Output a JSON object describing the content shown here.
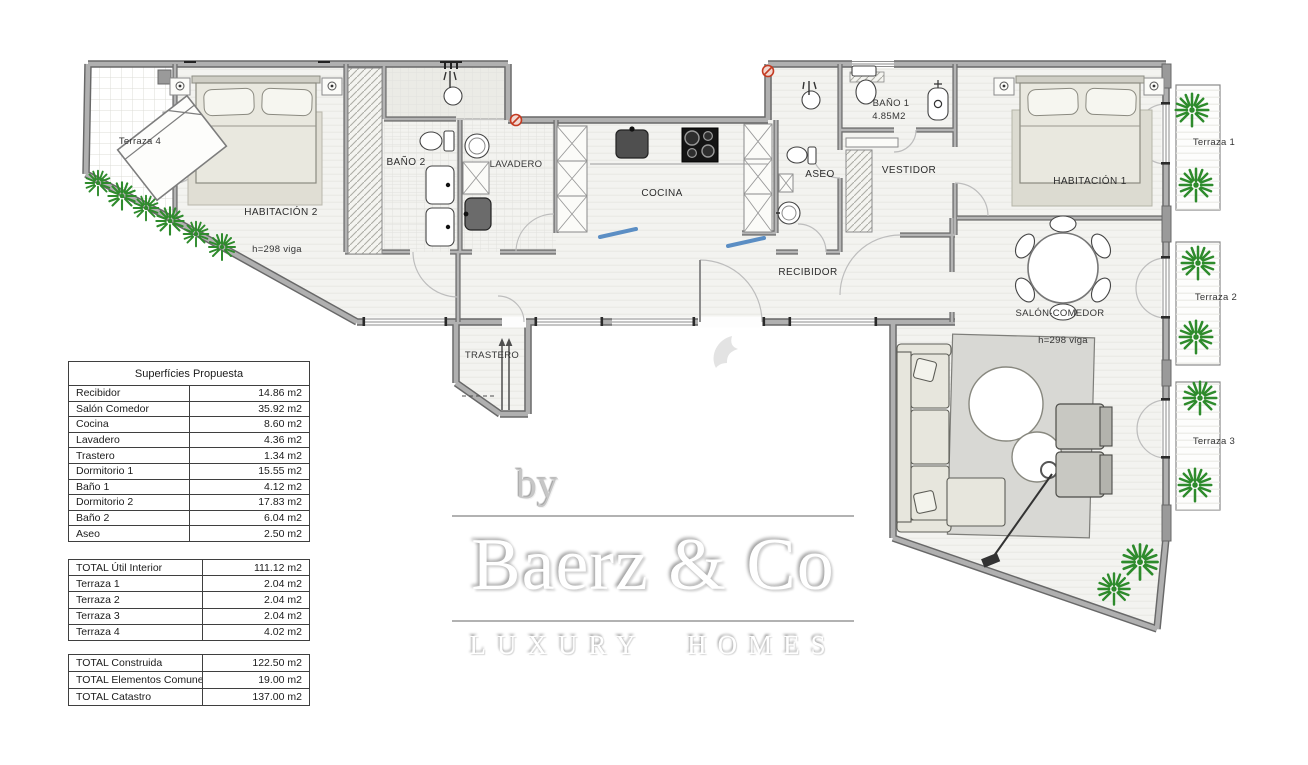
{
  "plan_labels": {
    "terraza4": "Terraza 4",
    "habitacion2": "HABITACIÓN 2",
    "viga_left": "h=298 viga",
    "bano2": "BAÑO 2",
    "lavadero": "LAVADERO",
    "cocina": "COCINA",
    "aseo": "ASEO",
    "bano1": "BAÑO 1",
    "bano1_area": "4.85M2",
    "vestidor": "VESTIDOR",
    "habitacion1": "HABITACIÓN 1",
    "recibidor": "RECIBIDOR",
    "salon": "SALÓN-COMEDOR",
    "viga_right": "h=298 viga",
    "trastero": "TRASTERO",
    "terraza1": "Terraza 1",
    "terraza2": "Terraza 2",
    "terraza3": "Terraza 3"
  },
  "surface_table": {
    "title": "Superfícies Propuesta",
    "rows": [
      {
        "label": "Recibidor",
        "value": "14.86 m2"
      },
      {
        "label": "Salón Comedor",
        "value": "35.92 m2"
      },
      {
        "label": "Cocina",
        "value": "8.60 m2"
      },
      {
        "label": "Lavadero",
        "value": "4.36 m2"
      },
      {
        "label": "Trastero",
        "value": "1.34 m2"
      },
      {
        "label": "Dormitorio 1",
        "value": "15.55 m2"
      },
      {
        "label": "Baño 1",
        "value": "4.12 m2"
      },
      {
        "label": "Dormitorio 2",
        "value": "17.83 m2"
      },
      {
        "label": "Baño 2",
        "value": "6.04 m2"
      },
      {
        "label": "Aseo",
        "value": "2.50 m2"
      }
    ]
  },
  "totals_interior": {
    "rows": [
      {
        "label": "TOTAL Útil Interior",
        "value": "111.12 m2"
      },
      {
        "label": "Terraza 1",
        "value": "2.04 m2"
      },
      {
        "label": "Terraza 2",
        "value": "2.04 m2"
      },
      {
        "label": "Terraza 3",
        "value": "2.04 m2"
      },
      {
        "label": "Terraza 4",
        "value": "4.02 m2"
      }
    ]
  },
  "totals_final": {
    "rows": [
      {
        "label": "TOTAL Construida",
        "value": "122.50 m2"
      },
      {
        "label": "TOTAL Elementos Comunes",
        "value": "19.00 m2"
      },
      {
        "label": "TOTAL Catastro",
        "value": "137.00 m2"
      }
    ]
  },
  "watermark": {
    "by": "by",
    "brand": "Baerz & Co",
    "tagline": "LUXURY HOMES"
  },
  "colors": {
    "wall_gray": "#8f8f8f",
    "floor_gray": "#f3f3f0",
    "plant_green": "#2e8b2c",
    "marker_blue": "#5b8ec4",
    "marker_red": "#c43b22",
    "watermark_gray": "#b2b2b2",
    "table_border": "#3f3f3f"
  }
}
